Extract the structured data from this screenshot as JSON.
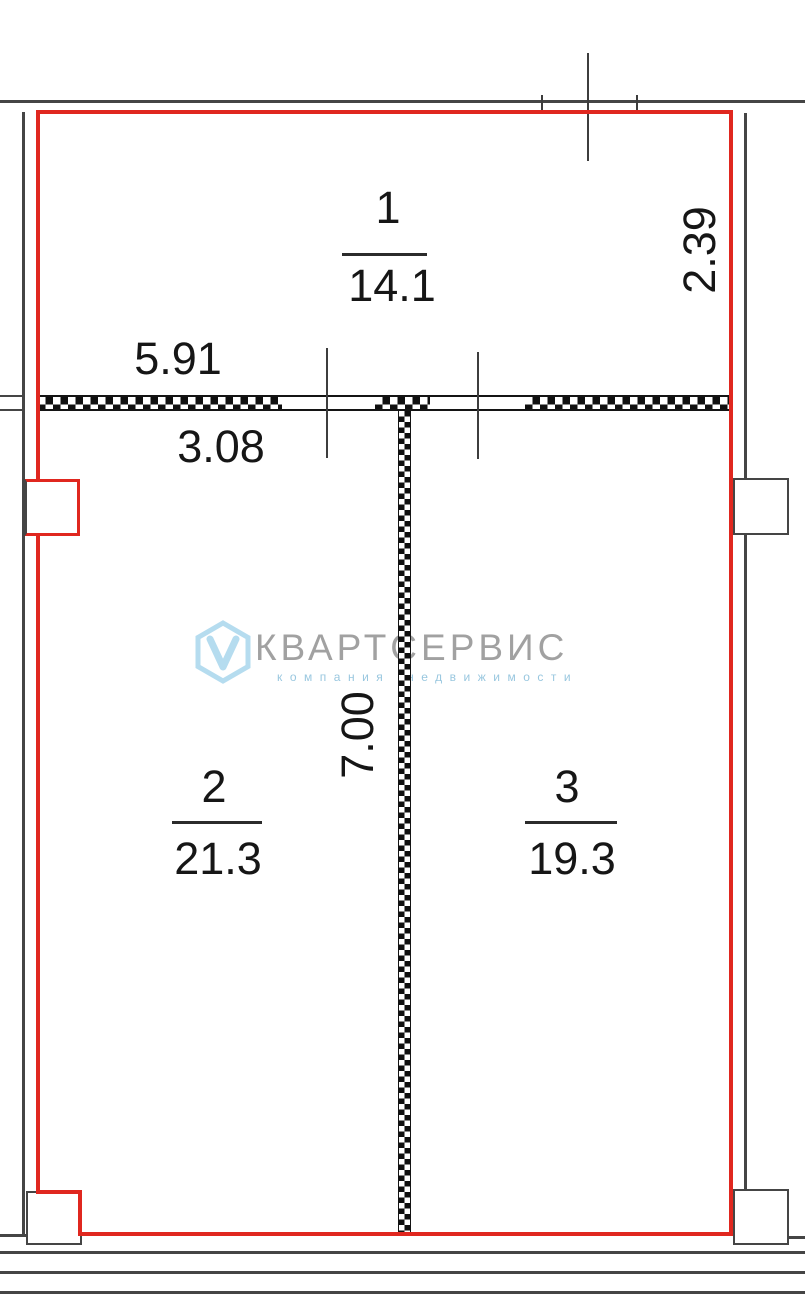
{
  "rooms": [
    {
      "number": "1",
      "area": "14.1"
    },
    {
      "number": "2",
      "area": "21.3"
    },
    {
      "number": "3",
      "area": "19.3"
    }
  ],
  "dimensions": {
    "wall_width_top": "5.91",
    "opening_width": "3.08",
    "height_right": "2.39",
    "partition_length": "7.00"
  },
  "watermark": {
    "brand": "КВАРТСЕРВИС",
    "tagline": "компания недвижимости",
    "logo_letter": "V"
  },
  "colors": {
    "boundary_red": "#e0271f",
    "wall_gray": "#454545",
    "hatch_black": "#0f0f0f",
    "watermark_blue": "#b5dcef",
    "watermark_gray": "#919191",
    "text_black": "#161616"
  }
}
